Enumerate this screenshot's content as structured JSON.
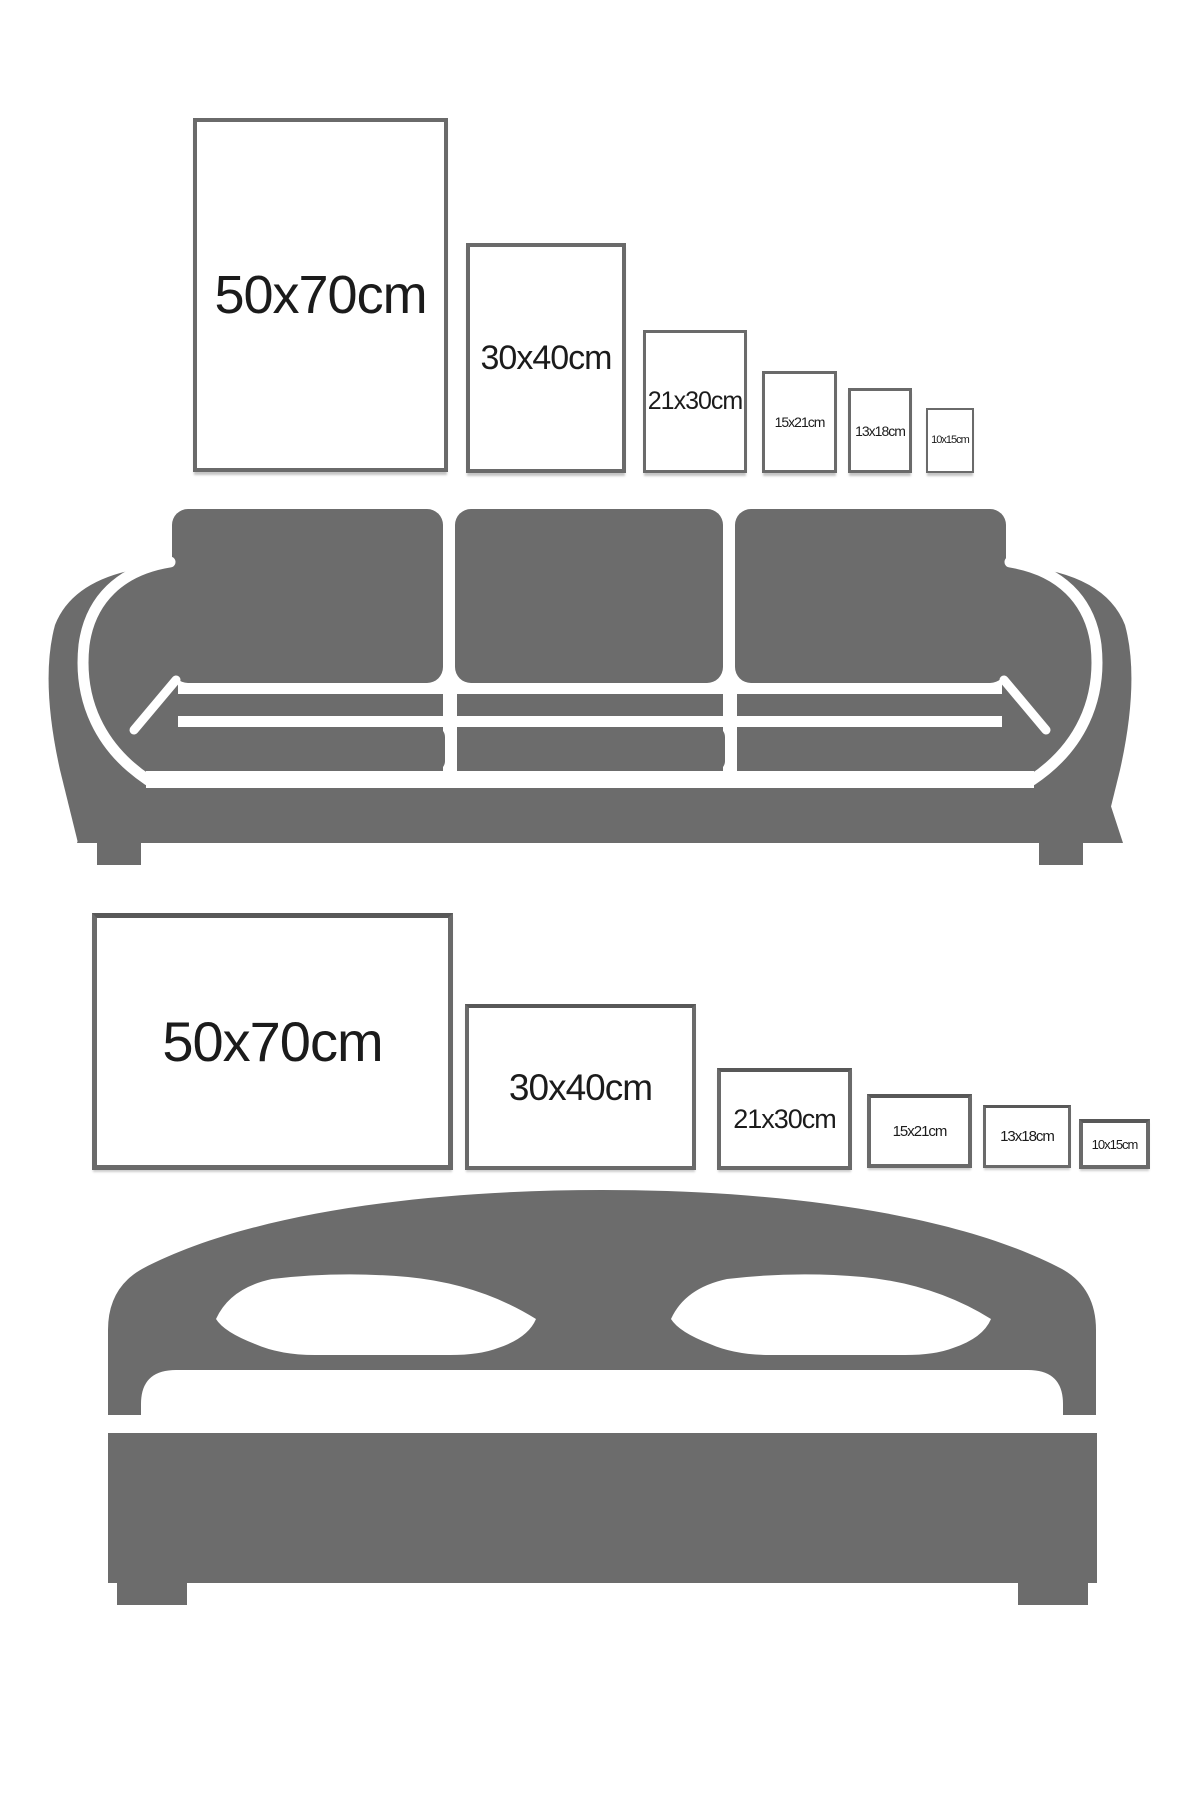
{
  "title": "Poster size comparison guide",
  "colors": {
    "furniture_gray": "#6c6c6c",
    "frame_border": "#6a6a6a",
    "frame_fill": "#ffffff",
    "label_text": "#1b1b1b",
    "background": "#ffffff"
  },
  "sections": {
    "sofa_guide": {
      "furniture": "sofa",
      "orientation": "portrait",
      "frames": [
        {
          "label": "50x70cm",
          "x": 193,
          "y": 118,
          "w": 255,
          "h": 354,
          "font": 54,
          "border": 4
        },
        {
          "label": "30x40cm",
          "x": 466,
          "y": 243,
          "w": 160,
          "h": 230,
          "font": 34,
          "border": 4
        },
        {
          "label": "21x30cm",
          "x": 643,
          "y": 330,
          "w": 104,
          "h": 143,
          "font": 25,
          "border": 3
        },
        {
          "label": "15x21cm",
          "x": 762,
          "y": 371,
          "w": 75,
          "h": 102,
          "font": 14,
          "border": 3
        },
        {
          "label": "13x18cm",
          "x": 848,
          "y": 388,
          "w": 64,
          "h": 85,
          "font": 14,
          "border": 3
        },
        {
          "label": "10x15cm",
          "x": 926,
          "y": 408,
          "w": 48,
          "h": 65,
          "font": 11,
          "border": 2
        }
      ]
    },
    "bed_guide": {
      "furniture": "bed",
      "orientation": "landscape",
      "frames": [
        {
          "label": "50x70cm",
          "x": 92,
          "y": 913,
          "w": 361,
          "h": 257,
          "font": 56,
          "border": 5
        },
        {
          "label": "30x40cm",
          "x": 465,
          "y": 1004,
          "w": 231,
          "h": 166,
          "font": 37,
          "border": 4
        },
        {
          "label": "21x30cm",
          "x": 717,
          "y": 1068,
          "w": 135,
          "h": 102,
          "font": 27,
          "border": 4
        },
        {
          "label": "15x21cm",
          "x": 867,
          "y": 1094,
          "w": 105,
          "h": 74,
          "font": 15,
          "border": 4
        },
        {
          "label": "13x18cm",
          "x": 983,
          "y": 1105,
          "w": 88,
          "h": 63,
          "font": 15,
          "border": 3
        },
        {
          "label": "10x15cm",
          "x": 1079,
          "y": 1119,
          "w": 71,
          "h": 50,
          "font": 13,
          "border": 4
        }
      ]
    }
  }
}
